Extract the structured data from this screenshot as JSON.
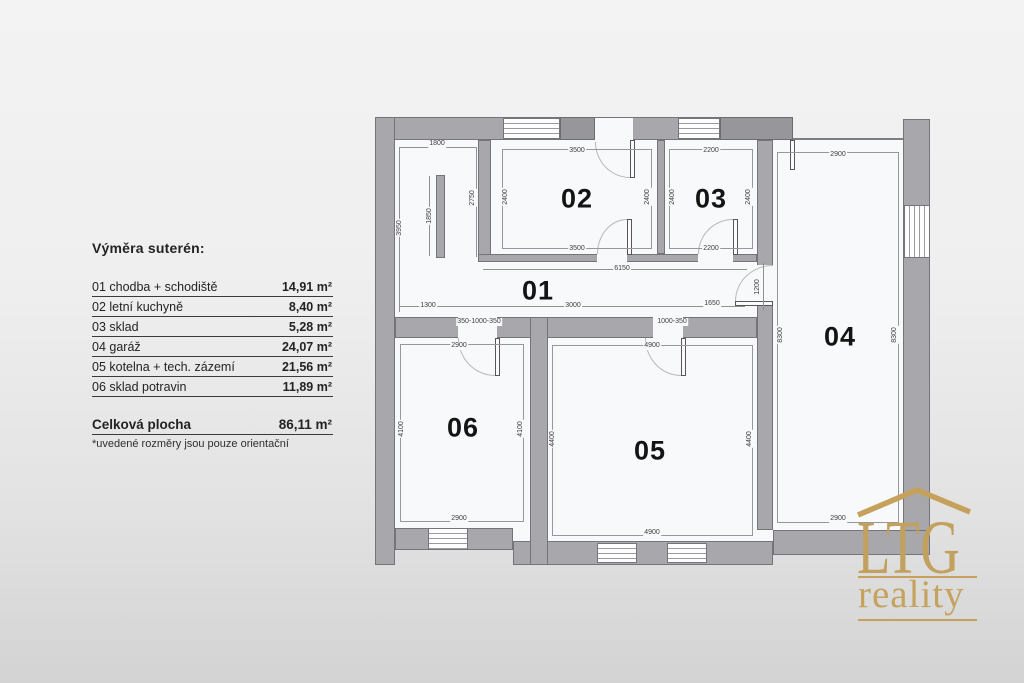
{
  "legend": {
    "title": "Výměra suterén:",
    "rows": [
      {
        "label": "01 chodba + schodiště",
        "value": "14,91 m²"
      },
      {
        "label": "02 letní kuchyně",
        "value": "8,40 m²"
      },
      {
        "label": "03 sklad",
        "value": "5,28 m²"
      },
      {
        "label": "04 garáž",
        "value": "24,07 m²"
      },
      {
        "label": "05 kotelna + tech. zázemí",
        "value": "21,56 m²"
      },
      {
        "label": "06 sklad potravin",
        "value": "11,89 m²"
      }
    ],
    "total": {
      "label": "Celková plocha",
      "value": "86,11 m²"
    },
    "note": "*uvedené rozměry jsou pouze orientační"
  },
  "logo": {
    "name": "LTG",
    "subtitle": "reality",
    "color": "#c2a05e"
  },
  "floorplan": {
    "room_labels": [
      {
        "t": "01",
        "x": 538,
        "y": 291
      },
      {
        "t": "02",
        "x": 577,
        "y": 199
      },
      {
        "t": "03",
        "x": 711,
        "y": 199
      },
      {
        "t": "04",
        "x": 840,
        "y": 337
      },
      {
        "t": "05",
        "x": 650,
        "y": 451
      },
      {
        "t": "06",
        "x": 463,
        "y": 428
      }
    ],
    "dimensions": [
      {
        "t": "1800",
        "x": 437,
        "y": 144
      },
      {
        "t": "3950",
        "x": 400,
        "y": 228,
        "r": 1
      },
      {
        "t": "1850",
        "x": 430,
        "y": 216,
        "r": 1
      },
      {
        "t": "2750",
        "x": 473,
        "y": 198,
        "r": 1
      },
      {
        "t": "3500",
        "x": 577,
        "y": 151
      },
      {
        "t": "3500",
        "x": 577,
        "y": 249
      },
      {
        "t": "2400",
        "x": 506,
        "y": 197,
        "r": 1
      },
      {
        "t": "2400",
        "x": 648,
        "y": 197,
        "r": 1
      },
      {
        "t": "2200",
        "x": 711,
        "y": 151
      },
      {
        "t": "2200",
        "x": 711,
        "y": 249
      },
      {
        "t": "2400",
        "x": 673,
        "y": 197,
        "r": 1
      },
      {
        "t": "2400",
        "x": 749,
        "y": 197,
        "r": 1
      },
      {
        "t": "2900",
        "x": 838,
        "y": 155
      },
      {
        "t": "2900",
        "x": 838,
        "y": 519
      },
      {
        "t": "8300",
        "x": 781,
        "y": 335,
        "r": 1
      },
      {
        "t": "8300",
        "x": 895,
        "y": 335,
        "r": 1
      },
      {
        "t": "6150",
        "x": 622,
        "y": 269
      },
      {
        "t": "1300",
        "x": 428,
        "y": 306
      },
      {
        "t": "3000",
        "x": 573,
        "y": 306
      },
      {
        "t": "1650",
        "x": 712,
        "y": 304
      },
      {
        "t": "1200",
        "x": 758,
        "y": 287,
        "r": 1
      },
      {
        "t": "350-1000-350",
        "x": 479,
        "y": 322
      },
      {
        "t": "1000-350",
        "x": 672,
        "y": 322
      },
      {
        "t": "2900",
        "x": 459,
        "y": 346
      },
      {
        "t": "2900",
        "x": 459,
        "y": 519
      },
      {
        "t": "4100",
        "x": 402,
        "y": 429,
        "r": 1
      },
      {
        "t": "4100",
        "x": 521,
        "y": 429,
        "r": 1
      },
      {
        "t": "4900",
        "x": 652,
        "y": 346
      },
      {
        "t": "4900",
        "x": 652,
        "y": 533
      },
      {
        "t": "4400",
        "x": 553,
        "y": 439,
        "r": 1
      },
      {
        "t": "4400",
        "x": 750,
        "y": 439,
        "r": 1
      }
    ]
  }
}
